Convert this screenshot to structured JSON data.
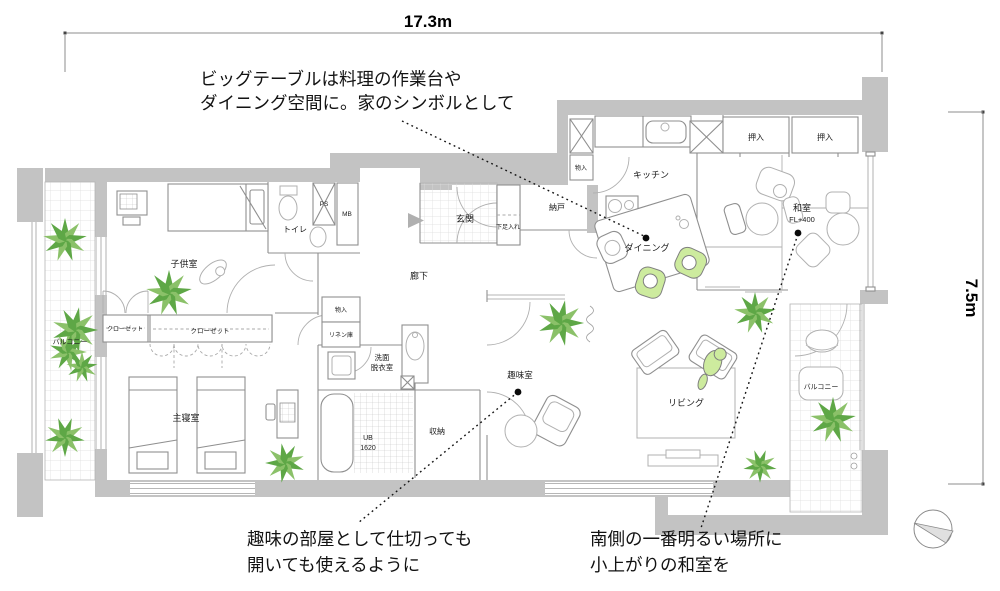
{
  "dimensions": {
    "width": "17.3m",
    "height": "7.5m"
  },
  "annotations": {
    "big_table": {
      "line1": "ビッグテーブルは料理の作業台や",
      "line2": "ダイニング空間に。家のシンボルとして"
    },
    "hobby_room": {
      "line1": "趣味の部屋として仕切っても",
      "line2": "開いても使えるように"
    },
    "tatami_room": {
      "line1": "南側の一番明るい場所に",
      "line2": "小上がりの和室を"
    }
  },
  "rooms": {
    "balcony_left": "バルコニー",
    "kids_room": "子供室",
    "closet_1": "クローゼット",
    "closet_2": "クローゼット",
    "master_bedroom": "主寝室",
    "toilet": "トイレ",
    "ps": "PS",
    "mb": "MB",
    "entrance": "玄関",
    "shoe_closet": "下足入れ",
    "storeroom": "納戸",
    "corridor": "廊下",
    "storage_small_1": "物入",
    "storage_small_2": "物入",
    "linen": "リネン庫",
    "washroom_line1": "洗面",
    "washroom_line2": "脱衣室",
    "ub_line1": "UB",
    "ub_line2": "1620",
    "storage_main": "収納",
    "hobby": "趣味室",
    "kitchen": "キッチン",
    "dining": "ダイニング",
    "oshiire_1": "押入",
    "oshiire_2": "押入",
    "tatami_line1": "和室",
    "tatami_line2": "FL+400",
    "living": "リビング",
    "balcony_right": "バルコニー"
  },
  "colors": {
    "wall": "#c3c3c3",
    "plant_green": "#5ea746",
    "plant_light": "#8bc169",
    "highlight_green": "#cdeb9e",
    "annotation_text": "#121212"
  }
}
